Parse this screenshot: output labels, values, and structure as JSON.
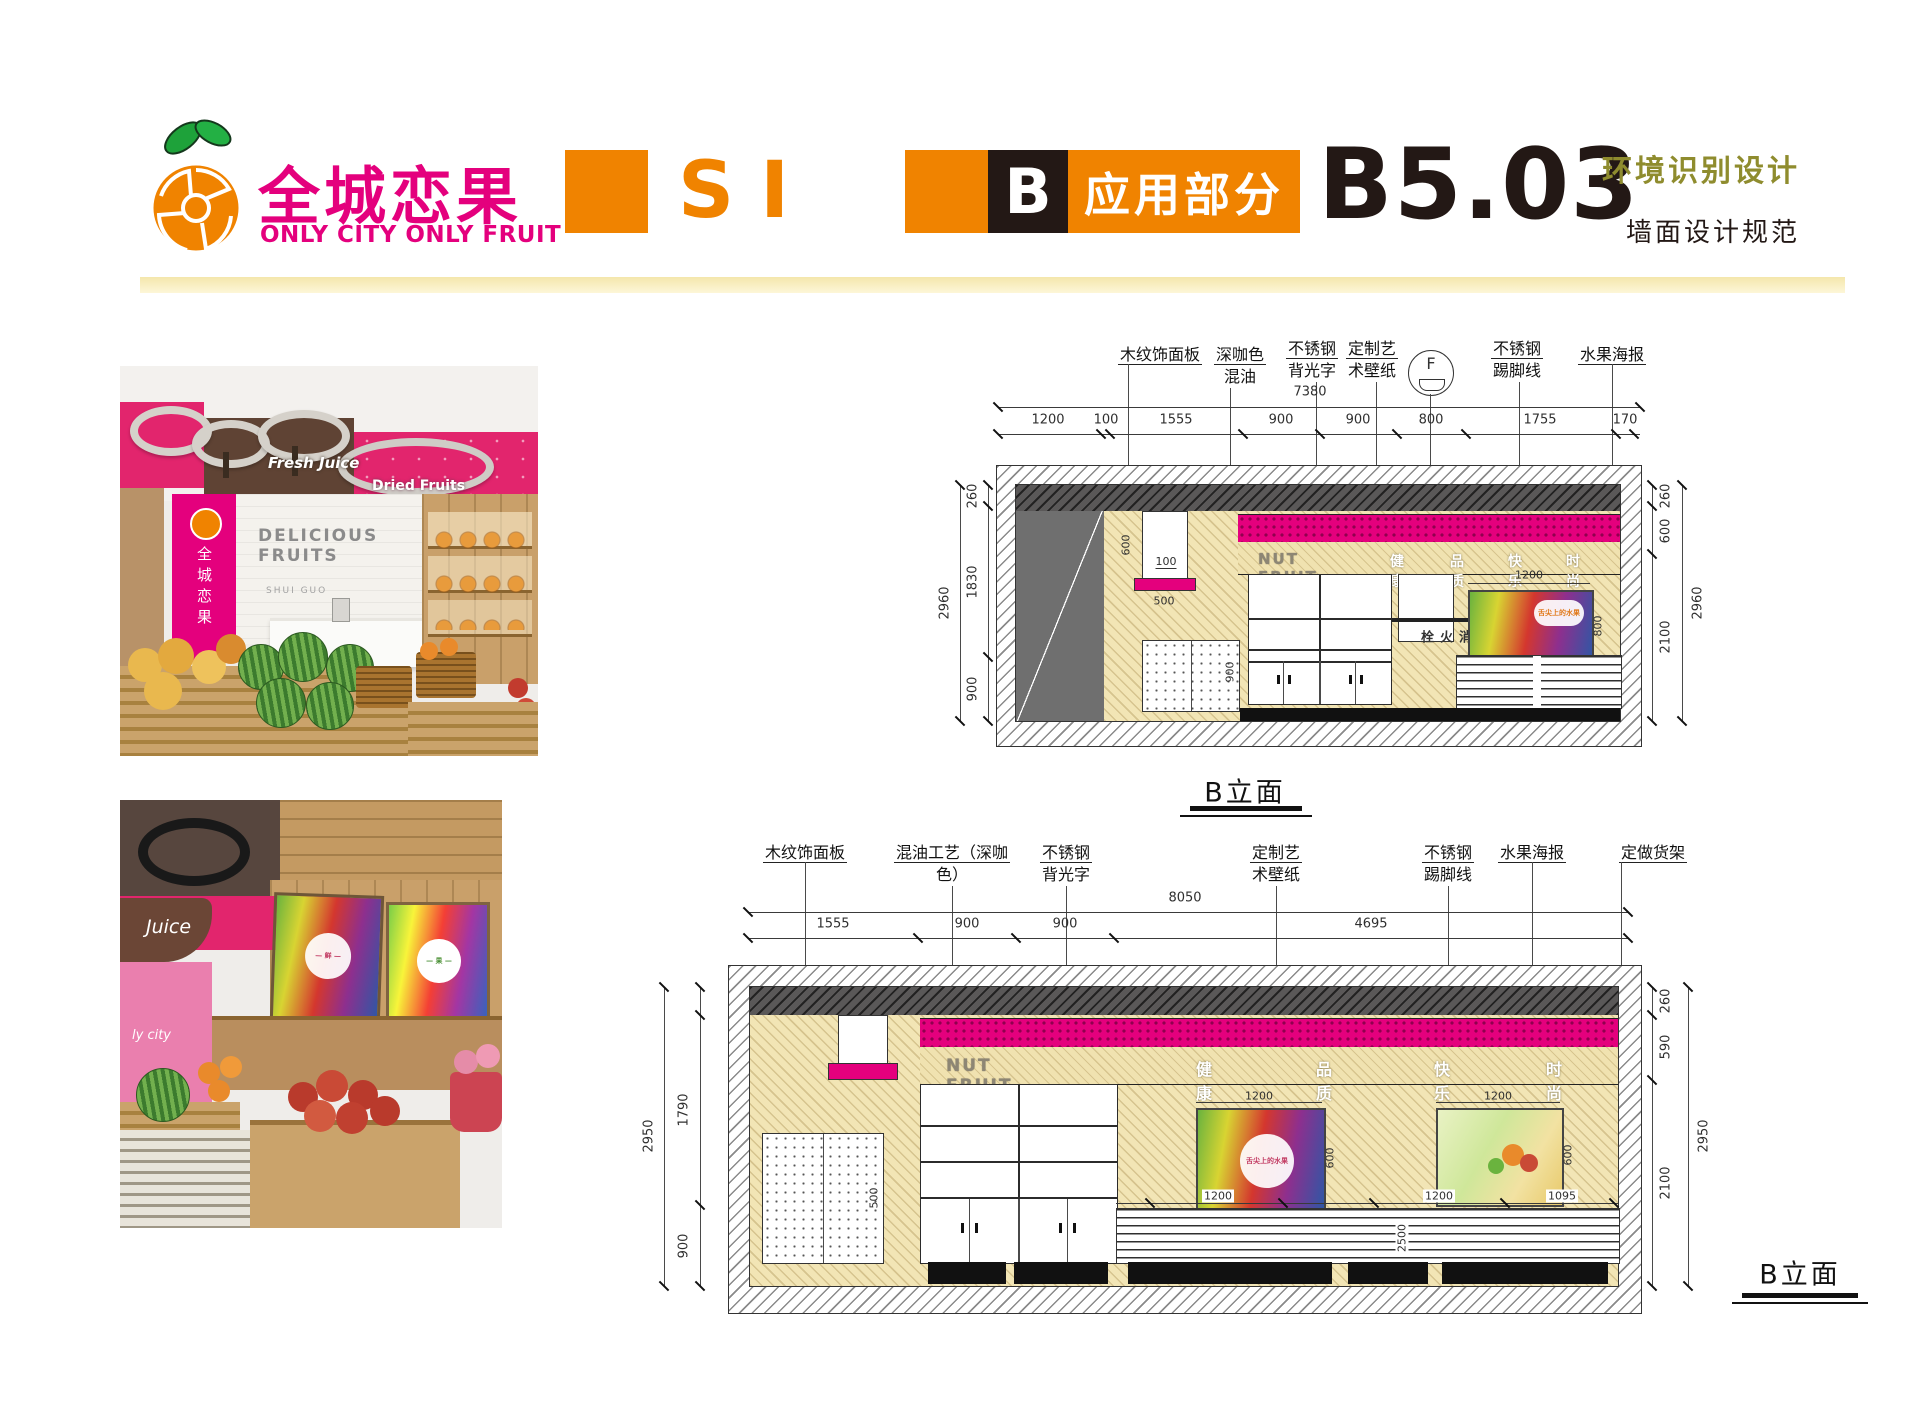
{
  "header": {
    "brand_cn": "全城恋果",
    "brand_en": "ONLY CITY ONLY FRUIT",
    "si": "SI",
    "section_letter": "B",
    "section_title": "应用部分",
    "code": "B5.03",
    "subtitle1": "环境识别设计",
    "subtitle2": "墙面设计规范"
  },
  "colors": {
    "orange": "#f08300",
    "magenta": "#e4007d",
    "olive": "#8f8c2e",
    "ink": "#231815"
  },
  "photo1": {
    "fresh_juice": "Fresh Juice",
    "dried_fruits": "Dried Fruits",
    "delicious": "DELICIOUS",
    "fruits": "FRUITS",
    "shuiguo": "SHUI GUO",
    "brand_vertical": "全城恋果"
  },
  "photo2": {
    "juice": "Juice",
    "city_text": "ly city"
  },
  "elev1": {
    "label": "B立面",
    "fan": "F",
    "ann": [
      {
        "l1": "木纹饰面板",
        "l2": ""
      },
      {
        "l1": "深咖色",
        "l2": "混油"
      },
      {
        "l1": "不锈钢",
        "l2": "背光字"
      },
      {
        "l1": "定制艺",
        "l2": "术壁纸"
      },
      {
        "l1": "不锈钢",
        "l2": "踢脚线"
      },
      {
        "l1": "水果海报",
        "l2": ""
      }
    ],
    "total": "7380",
    "segs": [
      "1200",
      "100",
      "1555",
      "900",
      "900",
      "800",
      "1755",
      "170"
    ],
    "left_total": "2960",
    "left_segs": [
      "260",
      "1830",
      "900"
    ],
    "right_total": "2960",
    "right_segs": [
      "260",
      "600",
      "2100"
    ],
    "nut": "NUT FRUIT",
    "words": [
      "健康",
      "品质",
      "快乐",
      "时尚"
    ],
    "hydrant": "消火栓",
    "recess_h": "600",
    "recess_gap": "100",
    "shelf_w": "500",
    "poster_w": "1200",
    "poster_h": "800",
    "poster_off": "900",
    "peg": "900",
    "poster_caption": "舌尖上的水果"
  },
  "elev2": {
    "label": "B立面",
    "ann": [
      {
        "l1": "木纹饰面板",
        "l2": ""
      },
      {
        "l1": "混油工艺（深咖",
        "l2": "色）"
      },
      {
        "l1": "不锈钢",
        "l2": "背光字"
      },
      {
        "l1": "定制艺",
        "l2": "术壁纸"
      },
      {
        "l1": "不锈钢",
        "l2": "踢脚线"
      },
      {
        "l1": "水果海报",
        "l2": ""
      },
      {
        "l1": "定做货架",
        "l2": ""
      }
    ],
    "total": "8050",
    "segs": [
      "1555",
      "900",
      "900",
      "4695"
    ],
    "left_total": "2950",
    "left_segs": [
      "1790",
      "900"
    ],
    "right_total": "2950",
    "right_segs": [
      "260",
      "590",
      "2100"
    ],
    "nut": "NUT FRUIT",
    "words": [
      "健康",
      "品质",
      "快乐",
      "时尚"
    ],
    "poster_w1": "1200",
    "poster_h1": "600",
    "poster_w2": "1200",
    "poster_h2": "600",
    "shelf_dims": [
      "1200",
      "1200",
      "1095"
    ],
    "shelf_v": "2500",
    "peg": "500",
    "poster_caption": "舌尖上的水果"
  }
}
